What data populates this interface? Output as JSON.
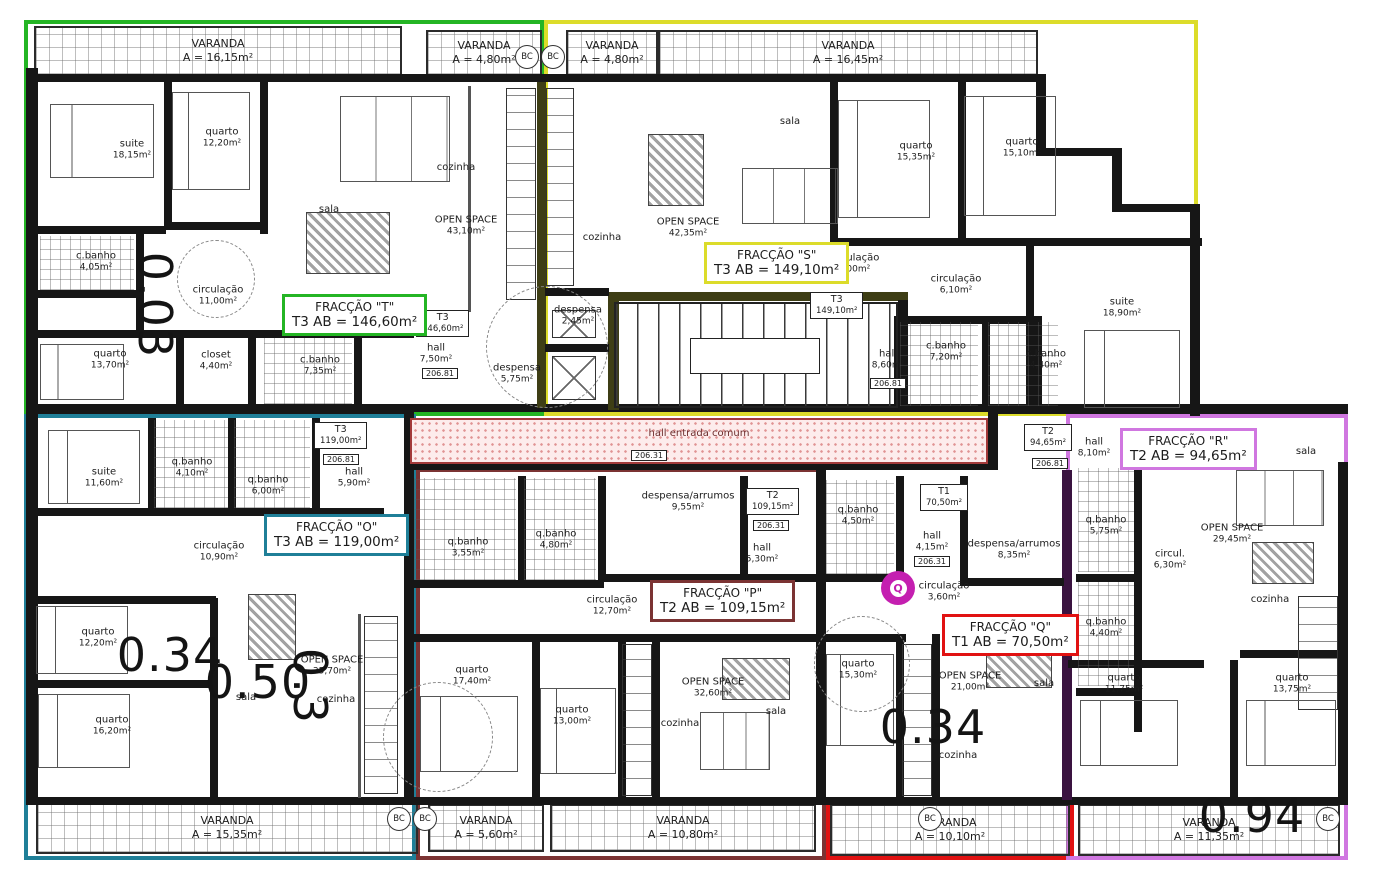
{
  "fraccoes": {
    "T": {
      "title": "FRACÇÃO \"T\"",
      "detail": "T3  AB = 146,60m²",
      "color": "#24b524",
      "tag_type": "T3",
      "tag_area": "146,60m²"
    },
    "S": {
      "title": "FRACÇÃO \"S\"",
      "detail": "T3  AB = 149,10m²",
      "color": "#dcdc2a",
      "tag_type": "T3",
      "tag_area": "149,10m²"
    },
    "O": {
      "title": "FRACÇÃO \"O\"",
      "detail": "T3  AB = 119,00m²",
      "color": "#1f7f98",
      "tag_type": "T3",
      "tag_area": "119,00m²"
    },
    "P": {
      "title": "FRACÇÃO \"P\"",
      "detail": "T2  AB = 109,15m²",
      "color": "#7b3333",
      "tag_type": "T2",
      "tag_area": "109,15m²"
    },
    "Q": {
      "title": "FRACÇÃO \"Q\"",
      "detail": "T1  AB = 70,50m²",
      "color": "#e11212",
      "tag_type": "T1",
      "tag_area": "70,50m²"
    },
    "R": {
      "title": "FRACÇÃO \"R\"",
      "detail": "T2  AB = 94,65m²",
      "color": "#d077e0",
      "tag_type": "T2",
      "tag_area": "94,65m²"
    }
  },
  "varandas": {
    "top_left": {
      "name": "VARANDA",
      "area": "A = 16,15m²"
    },
    "top_mid_left": {
      "name": "VARANDA",
      "area": "A = 4,80m²"
    },
    "top_mid_right": {
      "name": "VARANDA",
      "area": "A = 4,80m²"
    },
    "top_right": {
      "name": "VARANDA",
      "area": "A = 16,45m²"
    },
    "bottom_left": {
      "name": "VARANDA",
      "area": "A = 15,35m²"
    },
    "bottom_mid_left": {
      "name": "VARANDA",
      "area": "A = 5,60m²"
    },
    "bottom_mid": {
      "name": "VARANDA",
      "area": "A = 10,80m²"
    },
    "bottom_mid_right": {
      "name": "VARANDA",
      "area": "A = 10,10m²"
    },
    "bottom_right": {
      "name": "VARANDA",
      "area": "A = 11,35m²"
    }
  },
  "rooms": {
    "t_suite": {
      "n": "suite",
      "a": "18,15m²"
    },
    "t_quarto1": {
      "n": "quarto",
      "a": "12,20m²"
    },
    "t_cbanho1": {
      "n": "c.banho",
      "a": "4,05m²"
    },
    "t_circ": {
      "n": "circulação",
      "a": "11,00m²"
    },
    "t_quarto2": {
      "n": "quarto",
      "a": "13,70m²"
    },
    "t_closet": {
      "n": "closet",
      "a": "4,40m²"
    },
    "t_cbanho2": {
      "n": "c.banho",
      "a": "7,35m²"
    },
    "t_sala": {
      "n": "sala"
    },
    "t_cozinha": {
      "n": "cozinha"
    },
    "t_open": {
      "n": "OPEN SPACE",
      "a": "43,10m²"
    },
    "t_hall": {
      "n": "hall",
      "a": "7,50m²"
    },
    "t_despensa": {
      "n": "despensa",
      "a": "5,75m²"
    },
    "s_cozinha": {
      "n": "cozinha"
    },
    "s_open": {
      "n": "OPEN SPACE",
      "a": "42,35m²"
    },
    "s_sala": {
      "n": "sala"
    },
    "s_despensa": {
      "n": "despensa",
      "a": "2,45m²"
    },
    "s_quarto1": {
      "n": "quarto",
      "a": "15,35m²"
    },
    "s_quarto2": {
      "n": "quarto",
      "a": "15,10m²"
    },
    "s_circ1": {
      "n": "circulação",
      "a": "8,00m²"
    },
    "s_circ2": {
      "n": "circulação",
      "a": "6,10m²"
    },
    "s_suite": {
      "n": "suite",
      "a": "18,90m²"
    },
    "s_hall": {
      "n": "hall",
      "a": "8,60m²"
    },
    "s_cbanho1": {
      "n": "c.banho",
      "a": "7,20m²"
    },
    "s_cbanho2": {
      "n": "c.banho",
      "a": "4,40m²"
    },
    "o_suite": {
      "n": "suite",
      "a": "11,60m²"
    },
    "o_qbanho1": {
      "n": "q.banho",
      "a": "4,10m²"
    },
    "o_qbanho2": {
      "n": "q.banho",
      "a": "6,00m²"
    },
    "o_hall": {
      "n": "hall",
      "a": "5,90m²"
    },
    "o_circ": {
      "n": "circulação",
      "a": "10,90m²"
    },
    "o_quarto1": {
      "n": "quarto",
      "a": "12,20m²"
    },
    "o_quarto2": {
      "n": "quarto",
      "a": "16,20m²"
    },
    "o_open": {
      "n": "OPEN SPACE",
      "a": "35,70m²"
    },
    "o_sala": {
      "n": "sala"
    },
    "o_cozinha": {
      "n": "cozinha"
    },
    "p_qbanho1": {
      "n": "q.banho",
      "a": "3,55m²"
    },
    "p_qbanho2": {
      "n": "q.banho",
      "a": "4,80m²"
    },
    "p_despensa": {
      "n": "despensa/arrumos",
      "a": "9,55m²"
    },
    "p_hall": {
      "n": "hall",
      "a": "5,30m²"
    },
    "p_circ": {
      "n": "circulação",
      "a": "12,70m²"
    },
    "p_quarto1": {
      "n": "quarto",
      "a": "17,40m²"
    },
    "p_quarto2": {
      "n": "quarto",
      "a": "13,00m²"
    },
    "p_cozinha": {
      "n": "cozinha"
    },
    "p_open": {
      "n": "OPEN SPACE",
      "a": "32,60m²"
    },
    "p_sala": {
      "n": "sala"
    },
    "q_qbanho": {
      "n": "q.banho",
      "a": "4,50m²"
    },
    "q_hall": {
      "n": "hall",
      "a": "4,15m²"
    },
    "q_circ": {
      "n": "circulação",
      "a": "3,60m²"
    },
    "q_despensa": {
      "n": "despensa/arrumos",
      "a": "8,35m²"
    },
    "q_quarto": {
      "n": "quarto",
      "a": "15,30m²"
    },
    "q_open": {
      "n": "OPEN SPACE",
      "a": "21,00m²"
    },
    "q_cozinha": {
      "n": "cozinha"
    },
    "q_sala": {
      "n": "sala"
    },
    "r_hall": {
      "n": "hall",
      "a": "8,10m²"
    },
    "r_qbanho1": {
      "n": "q.banho",
      "a": "5,75m²"
    },
    "r_qbanho2": {
      "n": "q.banho",
      "a": "4,40m²"
    },
    "r_circ": {
      "n": "circul.",
      "a": "6,30m²"
    },
    "r_open": {
      "n": "OPEN SPACE",
      "a": "29,45m²"
    },
    "r_sala": {
      "n": "sala"
    },
    "r_cozinha": {
      "n": "cozinha"
    },
    "r_quarto1": {
      "n": "quarto",
      "a": "11,75m²"
    },
    "r_quarto2": {
      "n": "quarto",
      "a": "13,75m²"
    }
  },
  "common": {
    "hall_line1": "hall entrada",
    "hall_line2": "comum",
    "bc": "BC",
    "q_marker": "Q"
  },
  "levels": {
    "t": "206.81",
    "s": "206.81",
    "o": "206.81",
    "p": "206.31",
    "q": "206.31",
    "r": "206.81",
    "hall": "206.31"
  },
  "numbers": {
    "n1": "0.03",
    "n2": "0.34",
    "n3": "0.50",
    "n4": "0.3",
    "n5": "0.34",
    "n6": "0.94"
  }
}
